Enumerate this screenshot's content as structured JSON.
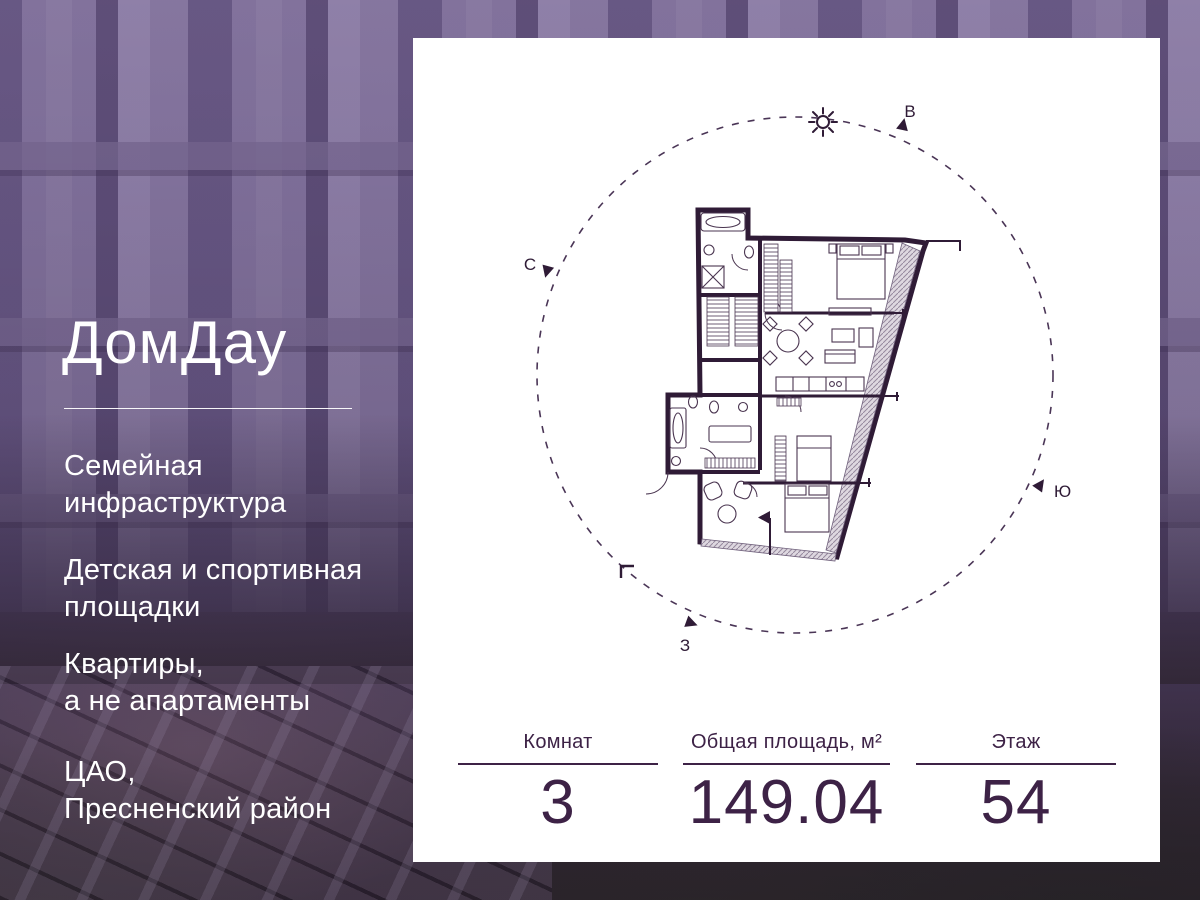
{
  "brand": {
    "logo_text": "ДомДау"
  },
  "features": [
    {
      "line1": "Семейная",
      "line2": "инфраструктура"
    },
    {
      "line1": "Детская и спортивная",
      "line2": "площадки"
    },
    {
      "line1": "Квартиры,",
      "line2": "а не апартаменты"
    },
    {
      "line1": "ЦАО,",
      "line2": "Пресненский район"
    }
  ],
  "card": {
    "compass": {
      "directions": {
        "north": "С",
        "east": "В",
        "south": "Ю",
        "west": "З"
      },
      "sun_icon": "sun"
    },
    "stats": [
      {
        "label": "Комнат",
        "value": "3"
      },
      {
        "label": "Общая площадь, м²",
        "value": "149.04"
      },
      {
        "label": "Этаж",
        "value": "54"
      }
    ]
  },
  "colors": {
    "accent": "#3d2246",
    "plan_ink": "#2f1b36",
    "card_bg": "#ffffff",
    "text_on_photo": "#ffffff",
    "photo_overlay": "#684e7e"
  }
}
